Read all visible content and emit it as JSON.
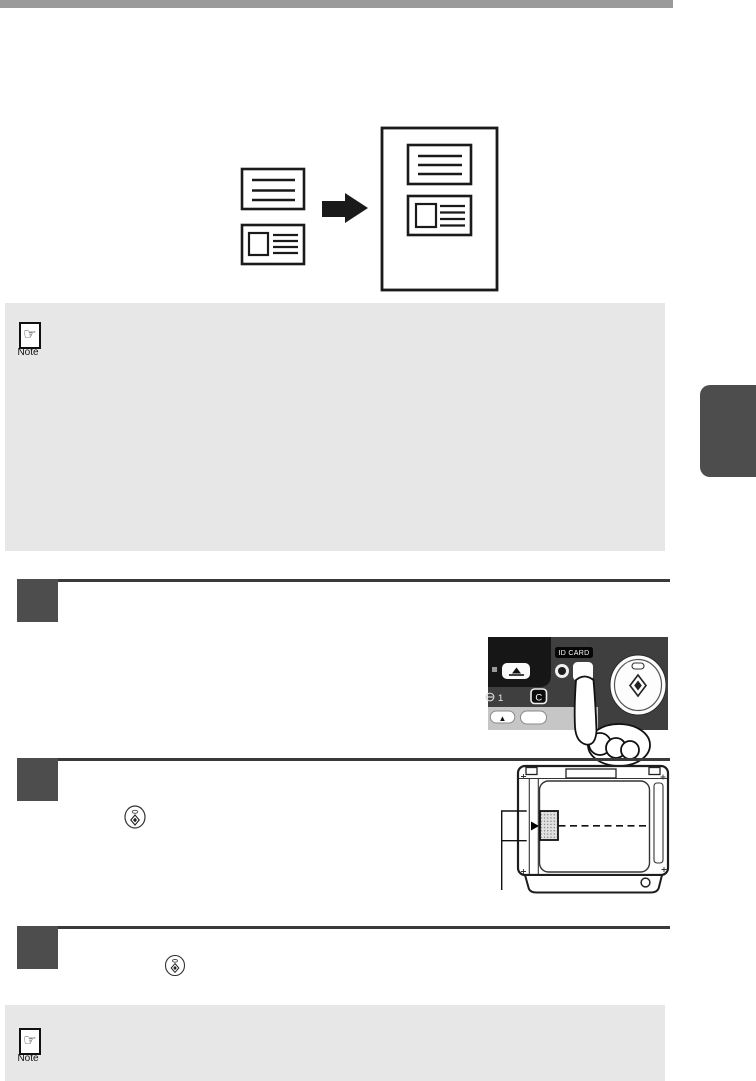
{
  "page": {
    "top_bar_color": "#9a9a9a",
    "chapter_tab_color": "#4d4d4d",
    "note_box_color": "#e7e7e7",
    "step_marker_color": "#4d4d4d",
    "step_rule_color": "#3a3a3a"
  },
  "notes": {
    "top": {
      "label": "Note"
    },
    "bottom": {
      "label": "Note"
    },
    "hand_icon_glyph": "☞"
  },
  "control_panel": {
    "id_card_label": "ID CARD",
    "copy_quantity_value": "1",
    "clear_label": "C",
    "up_arrow_glyph": "▲",
    "panel_bg_color": "#3f3f3f",
    "sub_panel_color": "#161616",
    "keypad_strip_color": "#c6c6c6"
  }
}
